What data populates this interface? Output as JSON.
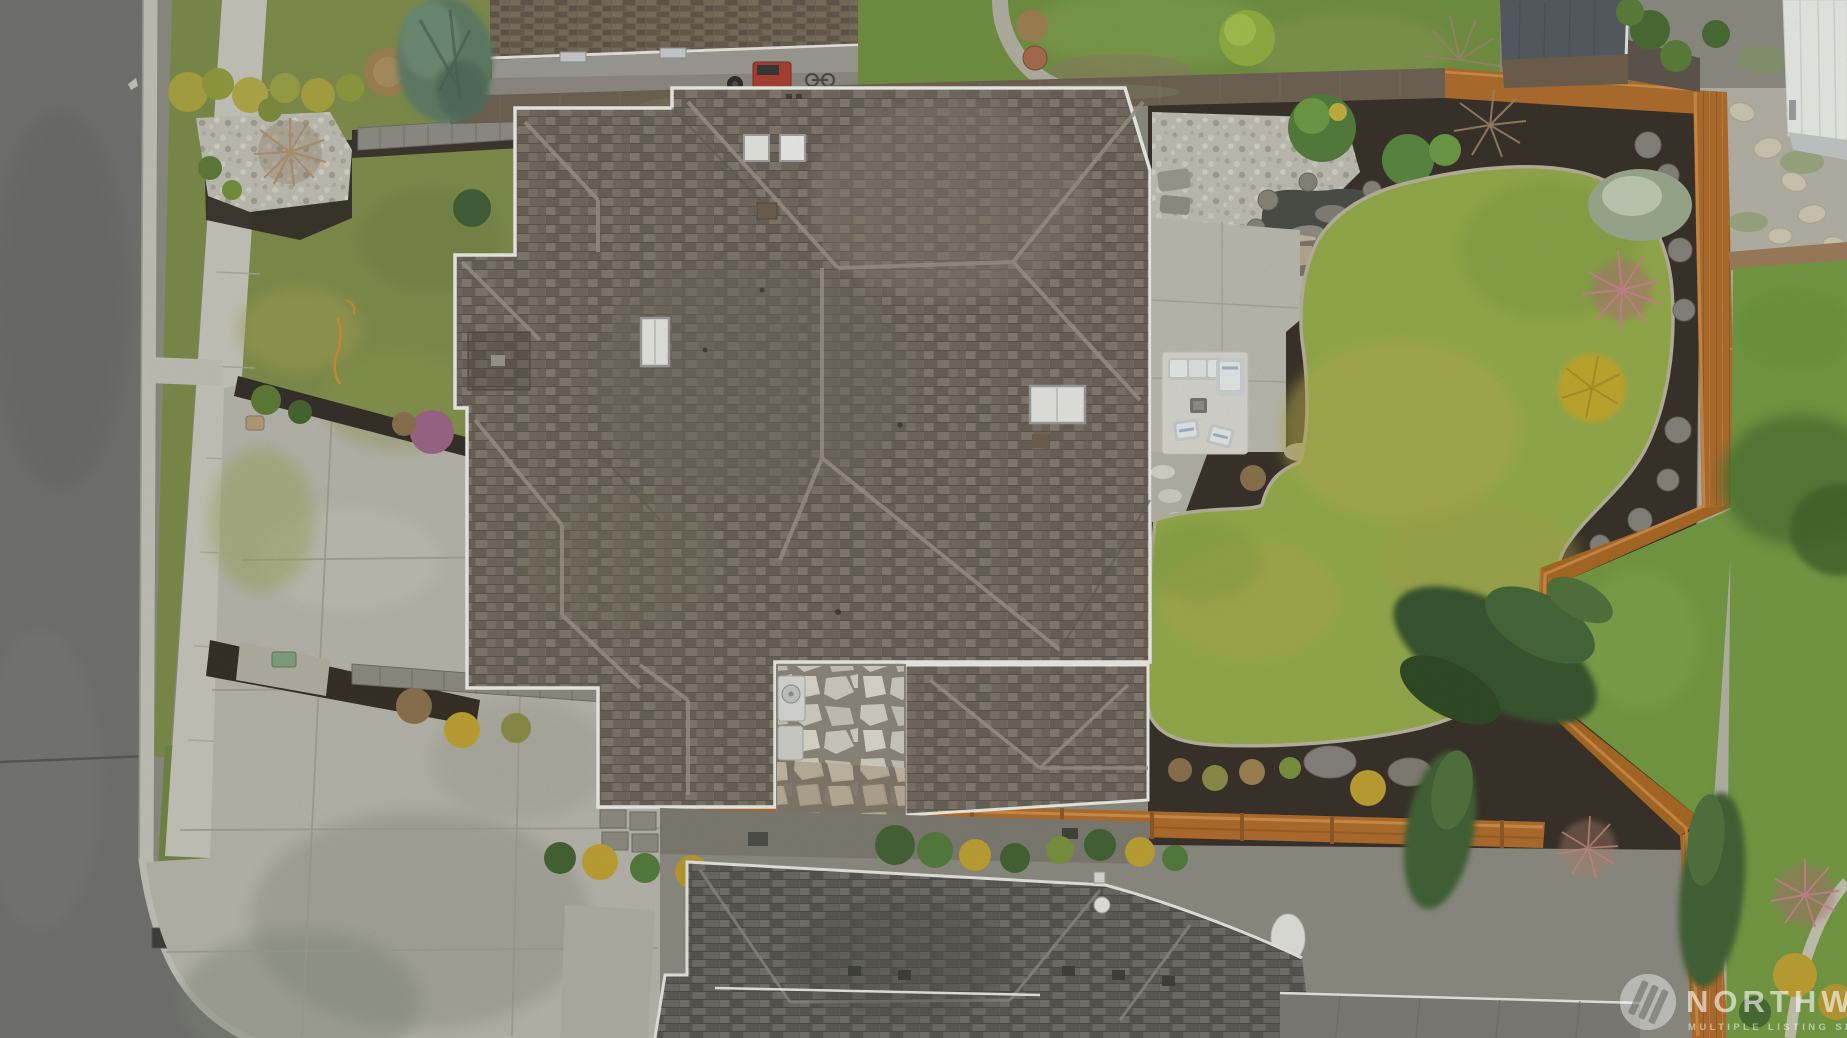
{
  "meta": {
    "kind": "aerial-drone-photo",
    "width_px": 1847,
    "height_px": 1038,
    "description": "Overhead aerial view of a residential corner lot: large hip-roof house with gray-brown composition shingles, concrete driveway, street and sidewalk on the left, landscaped backyard with kidney-shaped lawn, pond, flagstone patio, outdoor furniture, bright cedar fencing, and neighboring homes at the top, right and bottom edges."
  },
  "watermark": {
    "brand": "NORTHWEST",
    "tagline": "MULTIPLE LISTING SERVICE",
    "logo": "nwmls-triple-slash-icon",
    "style": "translucent-white-overlay"
  },
  "palette": {
    "asphalt": "#6f706c",
    "concrete": "#bcbbb1",
    "sidewalk": "#c7c6bc",
    "front_lawn": "#7d8c48",
    "back_lawn": "#93ab47",
    "neighbor_lawn": "#72993f",
    "mulch": "#2f2a23",
    "white_rock": "#c6c4b8",
    "roof_shingle": "#756c62",
    "neighbor_roof": "#61605a",
    "top_neighbor_roof": "#6d6053",
    "fascia_white": "#efefeb",
    "cedar_fence_orange": "#b06a28",
    "old_fence_brown": "#6b5f50",
    "pond_water": "#474a42",
    "flagstone_tan": "#b8ad96",
    "flagstone_white": "#d3d0c3",
    "gold_shrub": "#bfa02e",
    "pink_maple": "#c9808f",
    "purple_shrub": "#9c6286",
    "red_grill": "#a93b2c"
  },
  "scene": {
    "street": {
      "label": "asphalt street with curb, planting strip and sidewalk",
      "side": "left"
    },
    "driveway": {
      "label": "broad concrete driveway with expansion joints",
      "stains": "moss and tire staining near street"
    },
    "main_house": {
      "label": "subject house hip roof",
      "skylights": 4,
      "roof_vents": 2,
      "chimney": 1,
      "fascia": "white metal gutters outlining every roof step"
    },
    "rear_courtyard": {
      "label": "white flagstone courtyard with heat-pump unit"
    },
    "backyard": {
      "patio": "concrete slab patio with outdoor rug, sectional sofa, two chairs and fire table",
      "pond": "rock-edged water feature with river gravel",
      "lawn": "kidney-shaped lawn with concrete scallop edging",
      "plantings": "purple heather, pink japanese maple, gold cypress, frosted juniper, boulders in dark mulch"
    },
    "fences": {
      "rear_and_side": "bright orange cedar fence with jog",
      "top_boundary": "weathered brown wood fence",
      "neighbor_branch_fence": "orange fence stub on right"
    },
    "neighbors": {
      "top": "house with brown shake roof, patio, kettle grill, red barbecue cart, bicycle, stone fire-pit circle",
      "top_right": "shed with slate roof and white-roofed garage with gravel path and stepping stones",
      "right": "lawn with curved walking path and maple",
      "bottom": "large gray hip roof with ridge vents and white gutters"
    }
  }
}
